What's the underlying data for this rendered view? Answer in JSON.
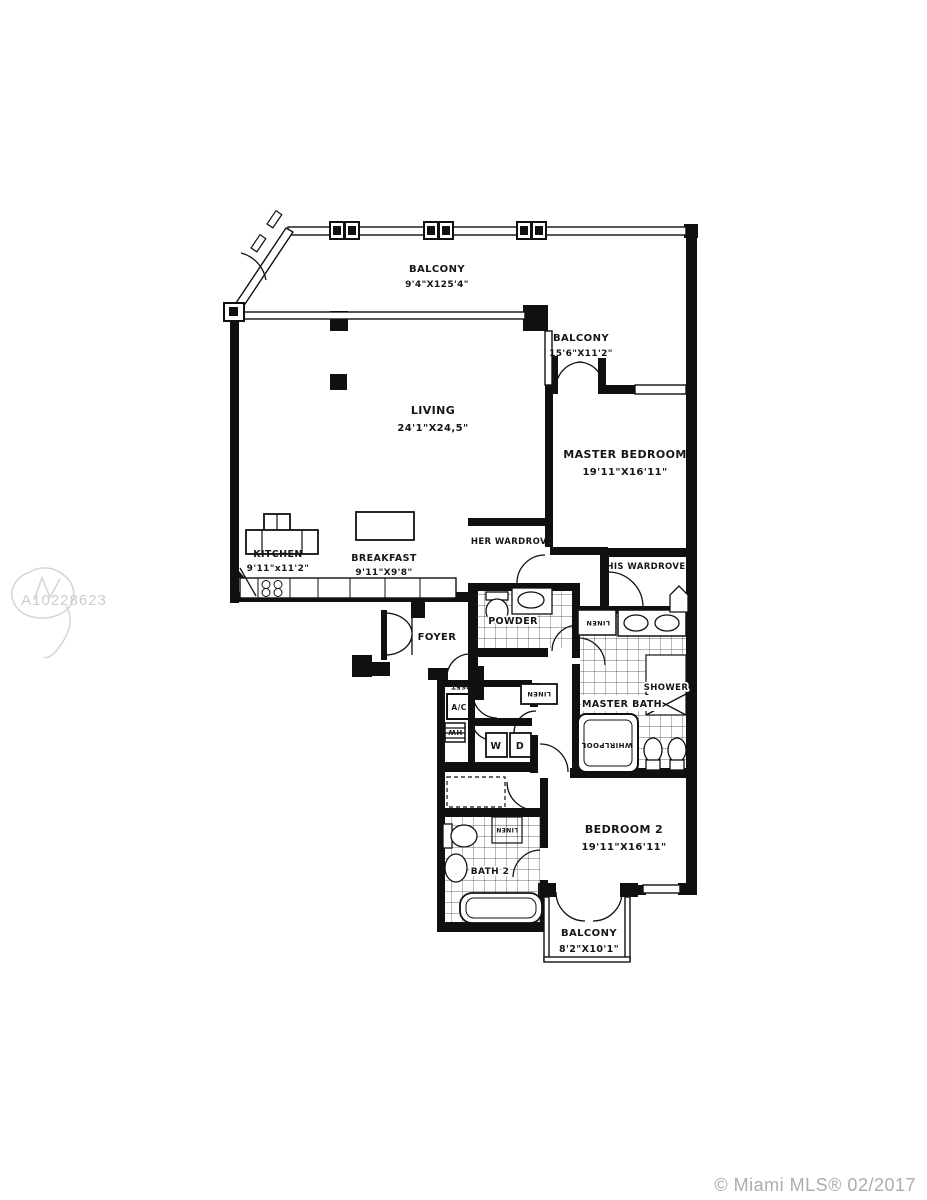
{
  "watermark": {
    "id": "A10228623"
  },
  "footer": {
    "copyright": "© Miami MLS® 02/2017"
  },
  "rooms": {
    "balcony_top": {
      "name": "BALCONY",
      "dims": "9'4\"X125'4\""
    },
    "balcony_master": {
      "name": "BALCONY",
      "dims": "15'6\"X11'2\""
    },
    "living": {
      "name": "LIVING",
      "dims": "24'1\"X24,5\""
    },
    "master_bedroom": {
      "name": "MASTER BEDROOM",
      "dims": "19'11\"X16'11\""
    },
    "kitchen": {
      "name": "KITCHEN",
      "dims": "9'11\"x11'2\""
    },
    "breakfast": {
      "name": "BREAKFAST",
      "dims": "9'11\"X9'8\""
    },
    "her_wardrobe": {
      "name": "HER WARDROVE"
    },
    "his_wardrobe": {
      "name": "HIS WARDROVE"
    },
    "powder": {
      "name": "POWDER"
    },
    "foyer": {
      "name": "FOYER"
    },
    "ac_closet": {
      "name": "A/C"
    },
    "water_heater": {
      "name": "HW"
    },
    "washer": {
      "name": "W"
    },
    "dryer": {
      "name": "D"
    },
    "closet": {
      "name": "CLOSET"
    },
    "linen_hall": {
      "name": "LINEN"
    },
    "linen_master": {
      "name": "LINEN"
    },
    "linen_bath2": {
      "name": "LINEN"
    },
    "master_bath": {
      "name": "MASTER BATH"
    },
    "shower": {
      "name": "SHOWER"
    },
    "whirlpool": {
      "name": "WHIRLPOOL"
    },
    "bedroom2": {
      "name": "BEDROOM 2",
      "dims": "19'11\"X16'11\""
    },
    "bath2": {
      "name": "BATH 2"
    },
    "balcony_bottom": {
      "name": "BALCONY",
      "dims": "8'2\"X10'1\""
    }
  },
  "colors": {
    "wall": "#101010",
    "watermark": "#cdcdcd",
    "footer_text": "#acacac"
  }
}
